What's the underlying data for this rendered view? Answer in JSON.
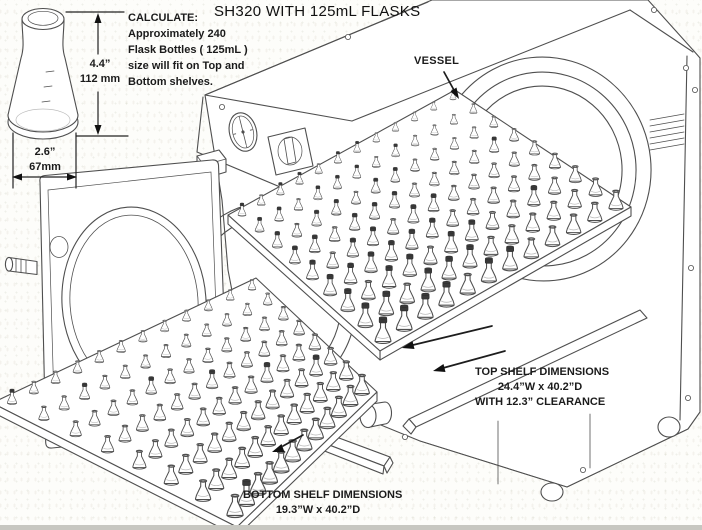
{
  "title": "SH320 WITH 125mL FLASKS",
  "calculate_note": {
    "heading": "CALCULATE:",
    "lines": [
      "Approximately 240",
      "Flask Bottles ( 125mL )",
      "size will fit on Top and",
      "Bottom shelves."
    ]
  },
  "flask_dimensions": {
    "height_in": "4.4”",
    "height_mm": "112 mm",
    "width_in": "2.6”",
    "width_mm": "67mm"
  },
  "labels": {
    "vessel": "VESSEL",
    "top_shelf": {
      "line1": "TOP SHELF DIMENSIONS",
      "line2": "24.4”W x 40.2”D",
      "line3": "WITH 12.3” CLEARANCE"
    },
    "bottom_shelf": {
      "line1": "BOTTOM SHELF DIMENSIONS",
      "line2": "19.3”W x 40.2”D"
    }
  },
  "colors": {
    "line": "#4f4f4f",
    "text": "#1b1b1b",
    "flask_cap": "#3a3a3a",
    "background": "#fdfdfa"
  }
}
